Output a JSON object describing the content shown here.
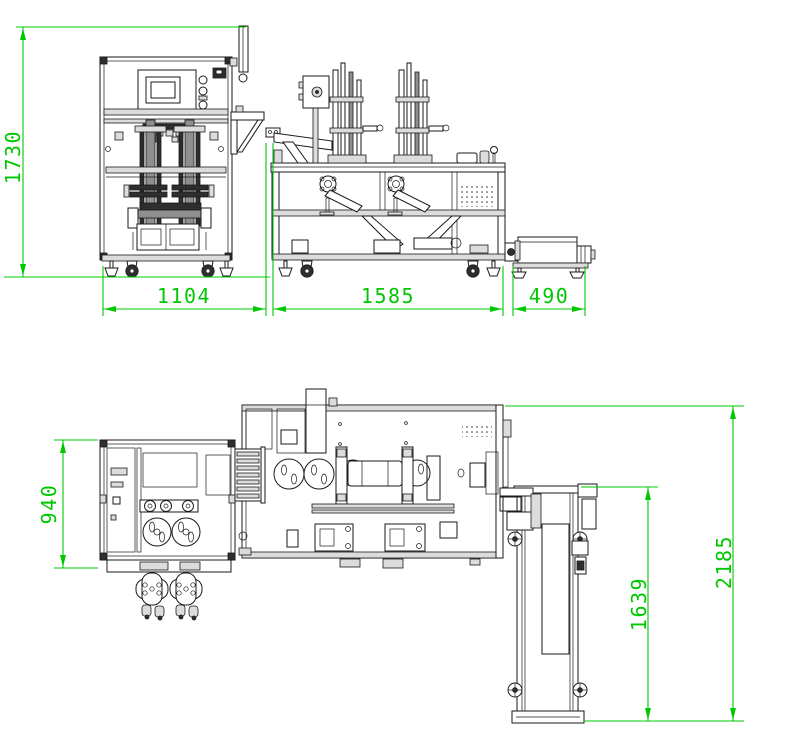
{
  "drawing": {
    "type": "CAD machine layout drawing, front elevation and top plan view",
    "background_color": "#ffffff",
    "line_color": "#1a1a1a",
    "dimension_color": "#00c800"
  },
  "front_view": {
    "overall_height": "1730",
    "left_machine_width": "1104",
    "center_machine_width": "1585",
    "right_unit_width": "490"
  },
  "plan_view": {
    "left_machine_depth": "940",
    "conveyor_length": "1639",
    "overall_depth": "2185"
  }
}
